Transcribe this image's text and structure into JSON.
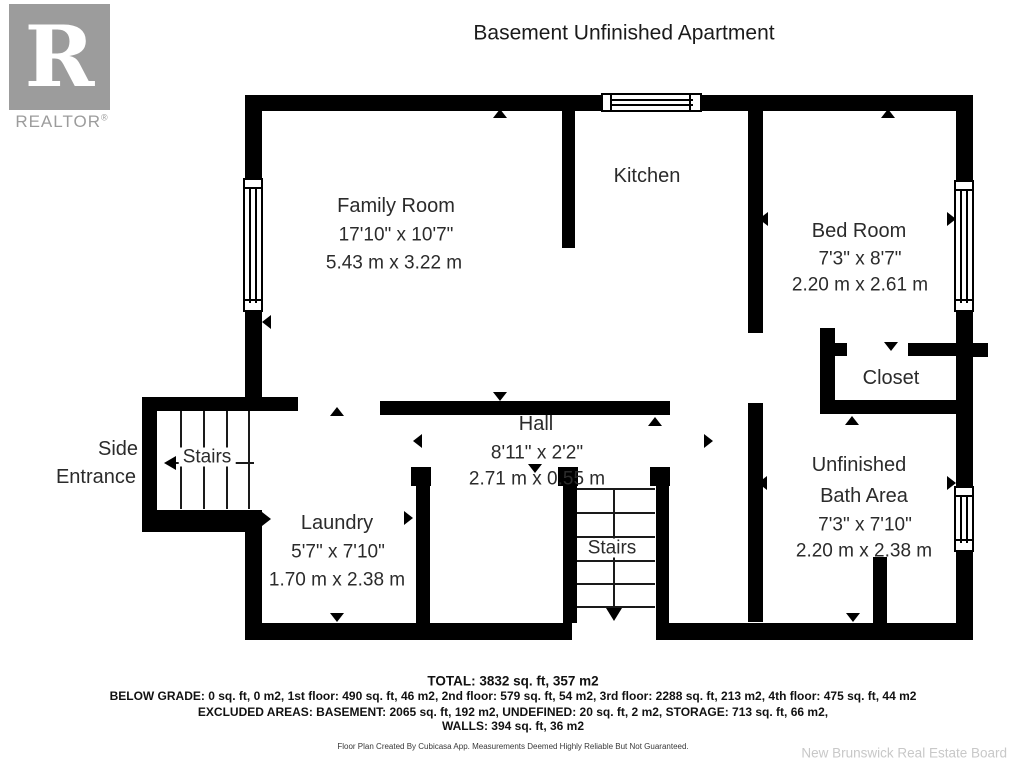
{
  "title": "Basement Unfinished Apartment",
  "logo": {
    "letter": "R",
    "brand": "REALTOR",
    "registered": "®"
  },
  "rooms": {
    "family_room": {
      "name": "Family Room",
      "dim_ft": "17'10\" x 10'7\"",
      "dim_m": "5.43 m x 3.22 m"
    },
    "kitchen": {
      "name": "Kitchen"
    },
    "bed_room": {
      "name": "Bed Room",
      "dim_ft": "7'3\" x 8'7\"",
      "dim_m": "2.20 m x 2.61 m"
    },
    "closet": {
      "name": "Closet"
    },
    "hall": {
      "name": "Hall",
      "dim_ft": "8'11\" x 2'2\"",
      "dim_m": "2.71 m x 0.55 m"
    },
    "laundry": {
      "name": "Laundry",
      "dim_ft": "5'7\" x 7'10\"",
      "dim_m": "1.70 m x 2.38 m"
    },
    "bath": {
      "name_line1": "Unfinished",
      "name_line2": "Bath Area",
      "dim_ft": "7'3\" x 7'10\"",
      "dim_m": "2.20 m x 2.38 m"
    },
    "side_entrance": {
      "line1": "Side",
      "line2": "Entrance"
    },
    "stairs_left": {
      "name": "Stairs"
    },
    "stairs_center": {
      "name": "Stairs"
    }
  },
  "footer": {
    "total": "TOTAL: 3832 sq. ft, 357 m2",
    "below_grade": "BELOW GRADE: 0 sq. ft, 0 m2, 1st floor: 490 sq. ft, 46 m2, 2nd floor: 579 sq. ft, 54 m2, 3rd floor: 2288 sq. ft, 213 m2, 4th floor: 475 sq. ft, 44 m2",
    "excluded": "EXCLUDED AREAS: BASEMENT: 2065 sq. ft, 192 m2, UNDEFINED: 20 sq. ft, 2 m2, STORAGE: 713 sq. ft, 66 m2,",
    "walls": "WALLS: 394 sq. ft, 36 m2",
    "disclaimer": "Floor Plan Created By Cubicasa App. Measurements Deemed Highly Reliable But Not Guaranteed.",
    "board": "New Brunswick Real Estate Board"
  },
  "colors": {
    "wall": "#000000",
    "logo_gray": "#9c9c9c",
    "label": "#2b2b2b",
    "watermark": "#c8c8c8"
  }
}
